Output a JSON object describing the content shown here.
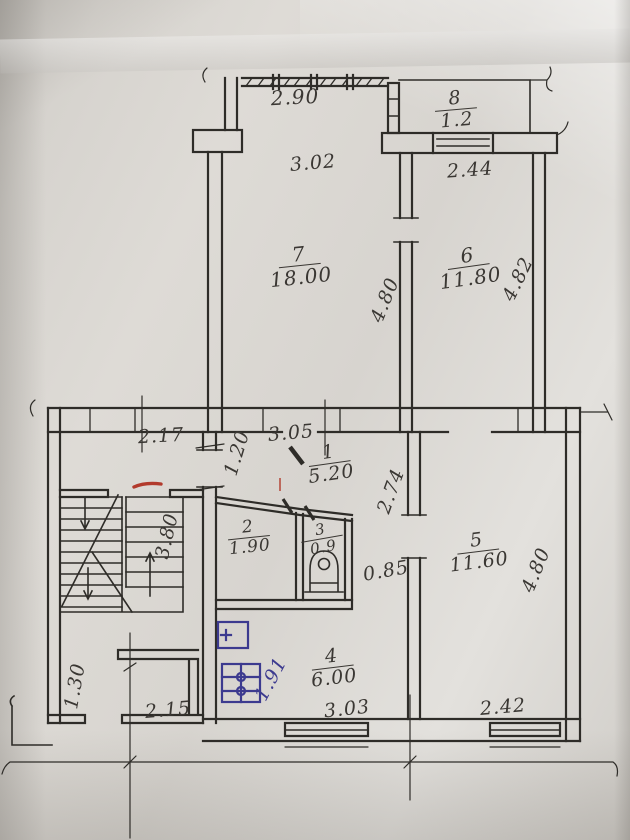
{
  "colors": {
    "paper": "#d8d4cf",
    "ink": "#2e2c28",
    "label_ink": "#3a3733",
    "blue_ink": "#3c3a8f",
    "red_mark": "#b23a2c"
  },
  "plan": {
    "rooms": [
      {
        "number": "1",
        "area": "5.20"
      },
      {
        "number": "2",
        "area": "1.90"
      },
      {
        "number": "3",
        "area": "0.9"
      },
      {
        "number": "4",
        "area": "6.00"
      },
      {
        "number": "5",
        "area": "11.60"
      },
      {
        "number": "6",
        "area": "11.80"
      },
      {
        "number": "7",
        "area": "18.00"
      },
      {
        "number": "8",
        "area": "1.2"
      }
    ],
    "dimensions": {
      "balcony_top": "2.90",
      "room7_top": "3.02",
      "room6_top": "2.44",
      "room7_side": "4.80",
      "room6_side": "4.82",
      "landing": "2.17",
      "hall_top": "3.05",
      "hall_left": "1.20",
      "hall_right": "2.74",
      "wc_passage": "0.85",
      "stairs_side": "3.80",
      "entry_side": "1.30",
      "entry_bottom": "2.15",
      "kitchen_bottom": "3.03",
      "kitchen_side": "1.91",
      "room5_bottom": "2.42",
      "room5_side": "4.80"
    }
  }
}
